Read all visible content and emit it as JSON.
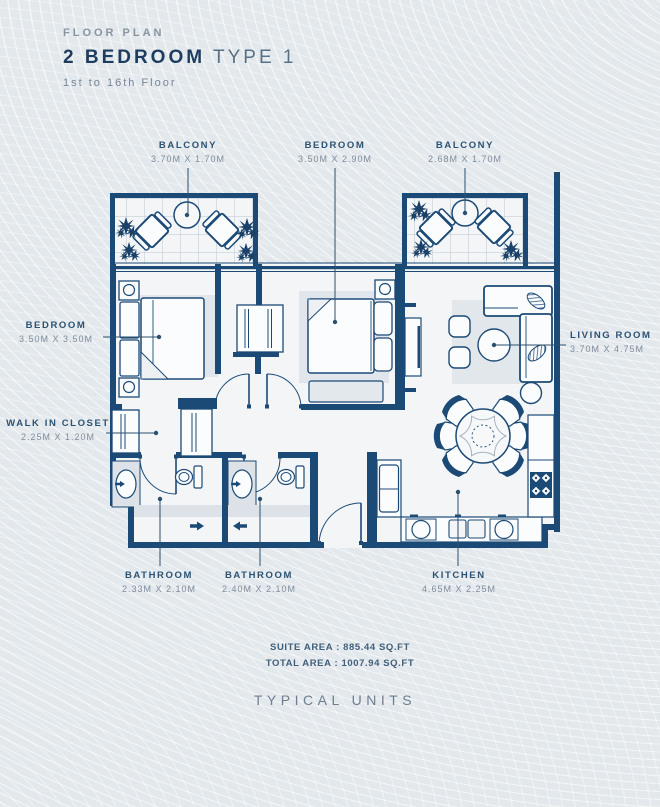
{
  "header": {
    "eyebrow": "FLOOR PLAN",
    "title_primary": "2 BEDROOM",
    "title_secondary": "TYPE 1",
    "subtitle": "1st to 16th Floor"
  },
  "rooms": {
    "balcony_left": {
      "name": "BALCONY",
      "dims": "3.70M X 1.70M"
    },
    "bedroom_top": {
      "name": "BEDROOM",
      "dims": "3.50M X 2.90M"
    },
    "balcony_right": {
      "name": "BALCONY",
      "dims": "2.68M X 1.70M"
    },
    "bedroom_left": {
      "name": "BEDROOM",
      "dims": "3.50M X 3.50M"
    },
    "walk_in_closet": {
      "name": "WALK IN CLOSET",
      "dims": "2.25M X 1.20M"
    },
    "living_room": {
      "name": "LIVING ROOM",
      "dims": "3.70M X 4.75M"
    },
    "bathroom_1": {
      "name": "BATHROOM",
      "dims": "2.33M X 2.10M"
    },
    "bathroom_2": {
      "name": "BATHROOM",
      "dims": "2.40M X 2.10M"
    },
    "kitchen": {
      "name": "KITCHEN",
      "dims": "4.65M X 2.25M"
    }
  },
  "areas": {
    "suite": "SUITE AREA : 885.44 SQ.FT",
    "total": "TOTAL AREA : 1007.94 SQ.FT"
  },
  "footer": {
    "label": "TYPICAL UNITS"
  },
  "colors": {
    "wall_navy": "#1c4a76",
    "title_navy": "#1d3c5e",
    "muted_blue": "#7e8d9d",
    "background": "#e3e8ec"
  }
}
